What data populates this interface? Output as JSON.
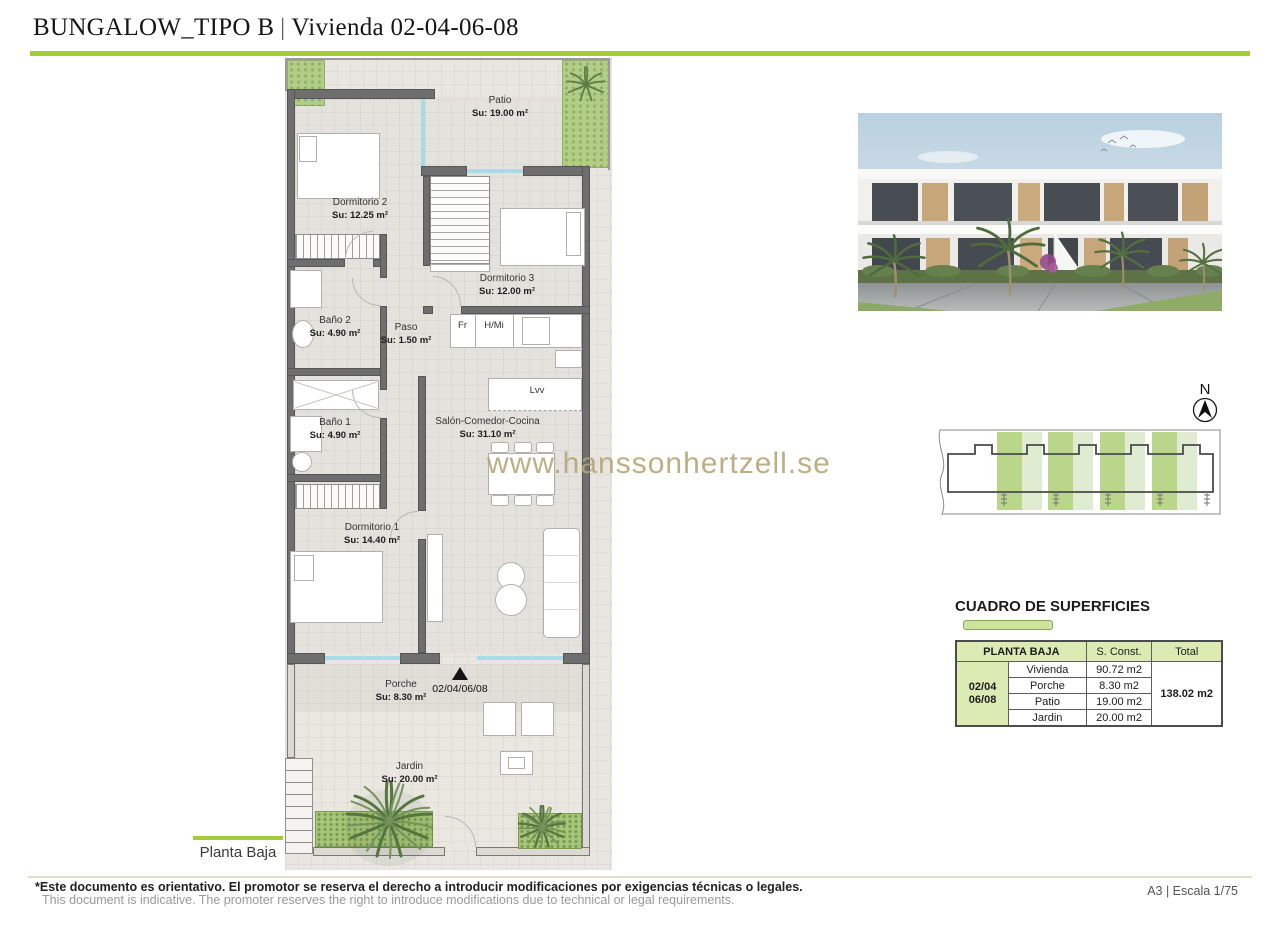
{
  "header": {
    "title_main": "BUNGALOW_TIPO B",
    "title_divider": "|",
    "title_sub": "Vivienda 02-04-06-08"
  },
  "plan": {
    "rooms": [
      {
        "name": "Patio",
        "area": "Su: 19.00 m²"
      },
      {
        "name": "Dormitorio 2",
        "area": "Su: 12.25 m²"
      },
      {
        "name": "Dormitorio 3",
        "area": "Su: 12.00 m²"
      },
      {
        "name": "Baño 2",
        "area": "Su: 4.90 m²"
      },
      {
        "name": "Paso",
        "area": "Su: 1.50 m²"
      },
      {
        "name": "Baño 1",
        "area": "Su: 4.90 m²"
      },
      {
        "name": "Salón-Comedor-Cocina",
        "area": "Su: 31.10 m²"
      },
      {
        "name": "Dormitorio 1",
        "area": "Su: 14.40 m²"
      },
      {
        "name": "Porche",
        "area": "Su: 8.30 m²"
      },
      {
        "name": "Jardin",
        "area": "Su: 20.00 m²"
      }
    ],
    "kitchen_labels": {
      "fridge": "Fr",
      "oven_micro": "H/Mi",
      "dishwasher": "Lvv"
    },
    "entry_label": "02/04/06/08",
    "floor_label": "Planta Baja"
  },
  "compass": {
    "north_label": "N"
  },
  "watermark": "www.hanssonhertzell.se",
  "areas_table": {
    "title": "CUADRO DE SUPERFICIES",
    "col_headers": [
      "PLANTA BAJA",
      "S. Const.",
      "Total"
    ],
    "unit_line1": "02/04",
    "unit_line2": "06/08",
    "rows": [
      {
        "label": "Vivienda",
        "value": "90.72 m2"
      },
      {
        "label": "Porche",
        "value": "8.30 m2"
      },
      {
        "label": "Patio",
        "value": "19.00 m2"
      },
      {
        "label": "Jardin",
        "value": "20.00 m2"
      }
    ],
    "total": "138.02 m2"
  },
  "footer": {
    "disclaimer_es": "*Este documento es orientativo. El promotor se reserva el derecho a introducir modificaciones por exigencias técnicas o legales.",
    "disclaimer_en": "This document is indicative. The promoter reserves the right to introduce modifications due to technical or legal requirements.",
    "sheet_info": "A3 | Escala 1/75"
  },
  "colors": {
    "accent_green": "#a3cc39",
    "table_green": "#dcebb4",
    "watermark_gold": "#b5a573",
    "wall_gray": "#6e6e6e",
    "glass_cyan": "#a7dbe7"
  }
}
